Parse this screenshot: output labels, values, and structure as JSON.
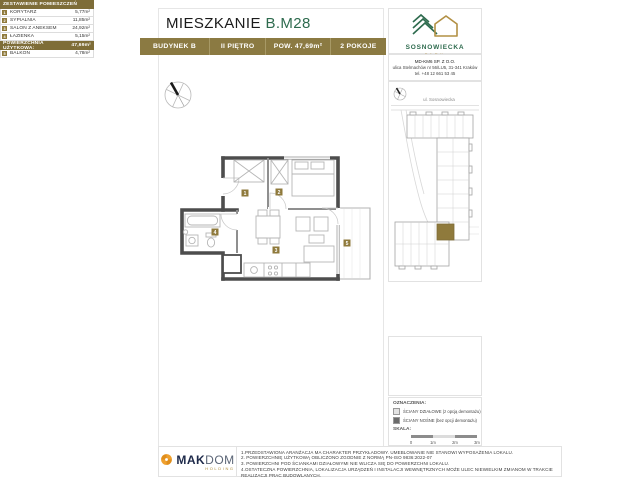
{
  "header": {
    "title": "MIESZKANIE",
    "unit": "B.M28",
    "building": "BUDYNEK B",
    "floor": "II PIĘTRO",
    "area": "POW.  47,69m²",
    "rooms": "2 POKOJE"
  },
  "developer": {
    "brand": "SOSNOWIECKA",
    "brand_sub": "PARK",
    "company": "MD-KM6 SP. Z O.O.",
    "address": "ulica Stelmachów nr 56/LU5, 31-341 Kraków",
    "phone": "tel. +48 12 661 53 45"
  },
  "site_map": {
    "street": "ul. Sosnowiecka"
  },
  "rooms_table": {
    "title": "ZESTAWIENIE POMIESZCZEŃ",
    "rows": [
      {
        "num": "1",
        "name": "KORYTARZ",
        "area": "5,77m²"
      },
      {
        "num": "2",
        "name": "SYPIALNIA",
        "area": "11,85m²"
      },
      {
        "num": "3",
        "name": "SALON Z ANEKSEM",
        "area": "24,92m²"
      },
      {
        "num": "4",
        "name": "ŁAZIENKA",
        "area": "5,15m²"
      }
    ],
    "total_label": "POWIERZCHNIA UŻYTKOWA:",
    "total": "47,69m²",
    "extra": {
      "num": "5",
      "name": "BALKON",
      "area": "4,78m²"
    }
  },
  "legend": {
    "title": "OZNACZENIA:",
    "items": [
      {
        "label": "ŚCIANY DZIAŁOWE (z opcją demontażu)"
      },
      {
        "label": "ŚCIANY NOŚNE (bez opcji demontażu)"
      }
    ]
  },
  "scale": {
    "title": "SKALA:",
    "labels": [
      "0",
      "1m",
      "2m",
      "3m"
    ]
  },
  "footer": {
    "brand_a": "MAK",
    "brand_b": "DOM",
    "brand_sub": "HOLDING",
    "notes": [
      "1.PRZEDSTAWIONA ARANŻACJA MA CHARAKTER PRZYKŁADOWY. UMEBLOWANIE NIE STANOWI WYPOSAŻENIA LOKALU.",
      "2. POWIERZCHNIĘ UŻYTKOWĄ OBLICZONO ZGODNIE Z NORMĄ PN-ISO 9836:2022-07",
      "3. POWIERZCHNI POD ŚCIANKAMI DZIAŁOWYMI NIE WLICZA SIĘ DO POWIERZCHNI LOKALU.",
      "4.OSTATECZNA POWIERZCHNIA, LOKALIZACJA URZĄDZEŃ I INSTALACJI WEWNĘTRZNYCH MOŻE ULEC NIEWIELKIM ZMIANOM W TRAKCIE REALIZACJI PRAC BUDOWLANYCH."
    ]
  },
  "colors": {
    "gold": "#8B7A42",
    "gold_dark": "#7E6D38",
    "green": "#2E6B4E",
    "wall": "#4D4D4D",
    "orange": "#EFA02E",
    "navy": "#1E2A4A"
  }
}
